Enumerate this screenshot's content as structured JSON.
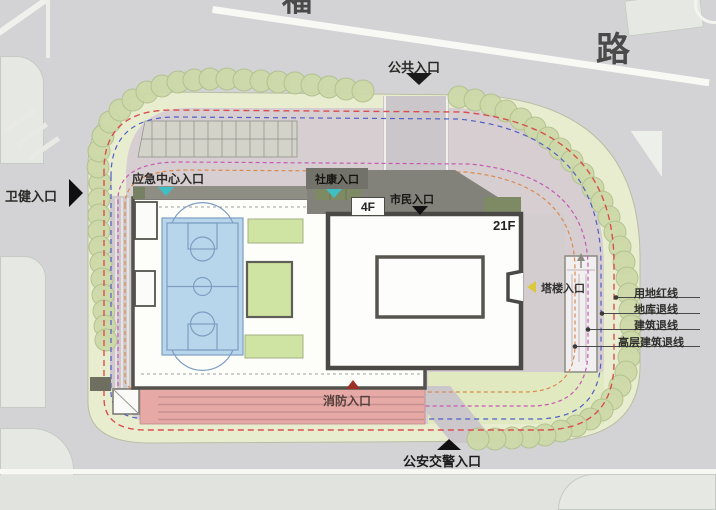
{
  "map": {
    "road_label": "路",
    "road_label_partial": "福",
    "entrances": {
      "public": "公共入口",
      "health": "卫健入口",
      "emergency_center": "应急中心入口",
      "community_clinic": "社康入口",
      "citizen": "市民入口",
      "tower": "塔楼入口",
      "fire": "消防入口",
      "police_traffic": "公安交警入口"
    },
    "buildings": {
      "podium_floors": "4F",
      "tower_floors": "21F"
    },
    "legend": [
      {
        "label": "用地红线",
        "color": "#d94f4f"
      },
      {
        "label": "地库退线",
        "color": "#4f5fc4"
      },
      {
        "label": "建筑退线",
        "color": "#c75ab4"
      },
      {
        "label": "高层建筑退线",
        "color": "#db8a4e"
      }
    ],
    "colors": {
      "road": "#d3d3d5",
      "site_green": "#e9edcf",
      "paving": "#d6ced1",
      "tree": "#cdd9a9",
      "court": "#b7d5eb",
      "fire_lane": "#e6a9a6",
      "roof_dark": "#83827a",
      "building_outline": "#4a4946",
      "entrance_marker_teal": "#3fbfc3",
      "entrance_marker_yellow": "#dcc83e",
      "entrance_marker_dark_red": "#9c2f26"
    }
  }
}
